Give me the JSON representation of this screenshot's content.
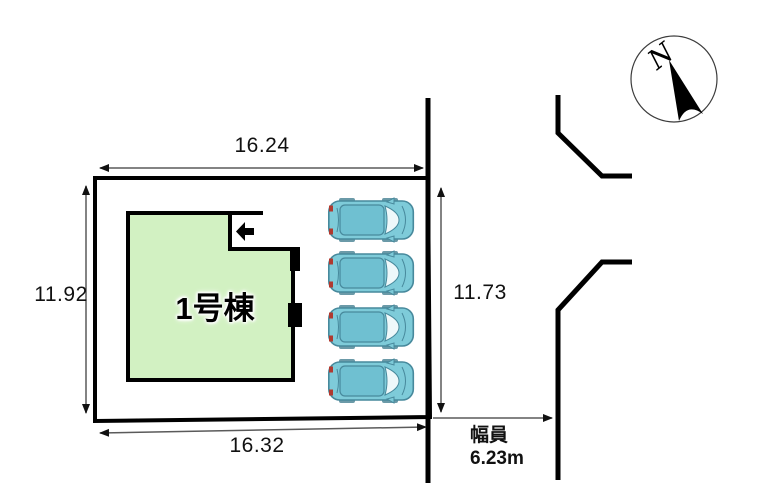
{
  "building": {
    "label": "1号棟"
  },
  "dimensions": {
    "top": "16.24",
    "left": "11.92",
    "right": "11.73",
    "bottom": "16.32"
  },
  "road_width": {
    "label": "幅員",
    "value": "6.23m"
  },
  "compass": {
    "north": "N"
  },
  "parking": {
    "car_count": 4
  },
  "colors": {
    "building_fill": "#d2f1c2",
    "car_body": "#7ecbd9",
    "car_roof": "#6fc0d1",
    "outline": "#000000",
    "dimension_line": "#5a5a5a"
  }
}
